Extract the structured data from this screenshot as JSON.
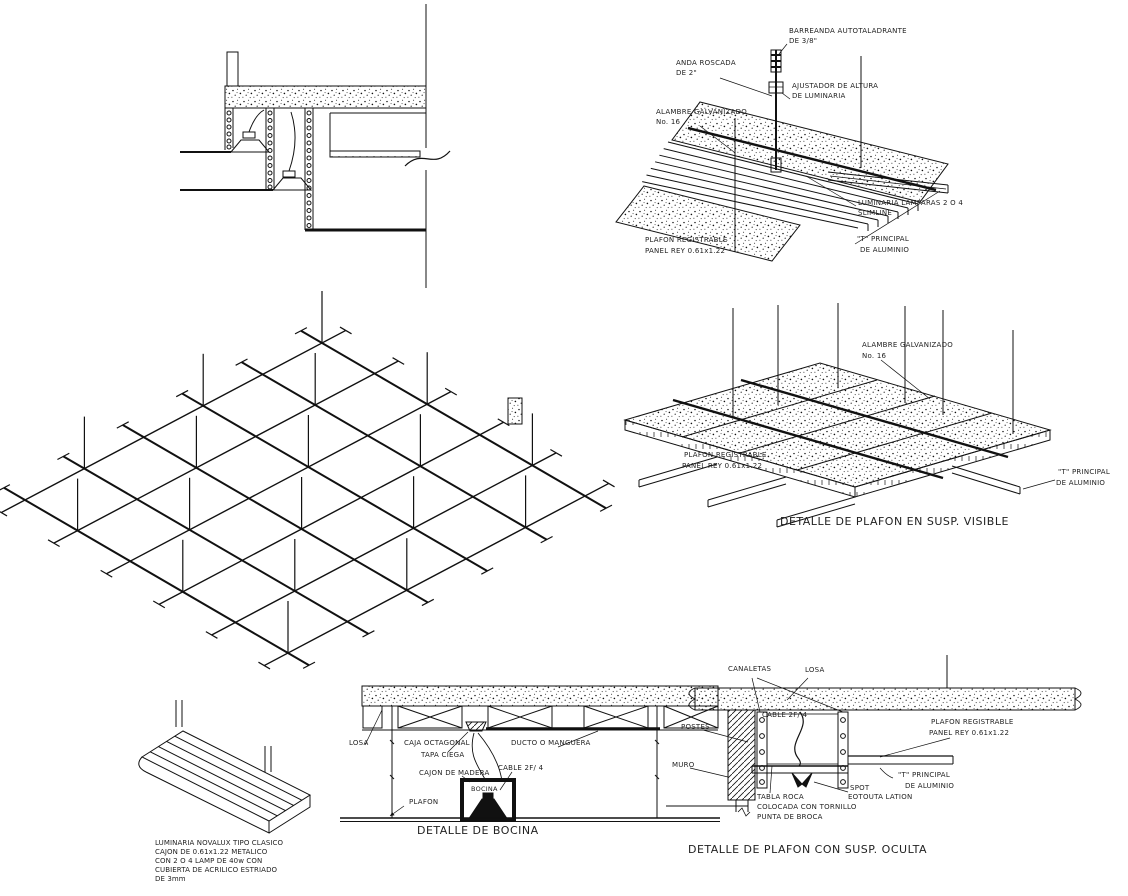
{
  "meta": {
    "background": "#ffffff",
    "ink": "#111111"
  },
  "top_right": {
    "barreanda_1": "BARREANDA AUTOTALADRANTE",
    "barreanda_2": "DE 3/8\"",
    "anda_1": "ANDA ROSCADA",
    "anda_2": "DE 2\"",
    "ajustador_1": "AJUSTADOR DE ALTURA",
    "ajustador_2": "DE LUMINARIA",
    "alambre_1": "ALAMBRE GALVANIZADO",
    "alambre_2": "No. 16",
    "luminaria_1": "LUMINARIA LAMPARAS 2 O 4",
    "luminaria_2": "SLIMLINE",
    "plafon_1": "PLAFON REGISTRABLE",
    "plafon_2": "PANEL REY 0.61x1.22",
    "t_principal_1": "\"T\" PRINCIPAL",
    "t_principal_2": "DE ALUMINIO"
  },
  "mid_right": {
    "alambre_1": "ALAMBRE GALVANIZADO",
    "alambre_2": "No. 16",
    "plafon_1": "PLAFON REGISTRABLE",
    "plafon_2": "PANEL REY 0.61x1.22",
    "t_principal_1": "\"T\" PRINCIPAL",
    "t_principal_2": "DE ALUMINIO",
    "title": "DETALLE DE PLAFON EN SUSP. VISIBLE"
  },
  "luminaire": {
    "note_1": "LUMINARIA NOVALUX TIPO CLASICO",
    "note_2": "CAJON DE 0.61x1.22 METALICO",
    "note_3": "CON 2 O 4 LAMP DE 40w CON",
    "note_4": "CUBIERTA DE ACRILICO ESTRIADO",
    "note_5": "DE 3mm"
  },
  "bocina": {
    "losa": "LOSA",
    "caja_1": "CAJA OCTAGONAL",
    "caja_2": "TAPA CIEGA",
    "cajon": "CAJON DE MADERA",
    "ducto": "DUCTO O MANGUERA",
    "cable": "CABLE 2F/ 4",
    "bocina": "BOCINA",
    "plafon": "PLAFON",
    "title": "DETALLE DE BOCINA"
  },
  "oculta": {
    "canaletas": "CANALETAS",
    "losa": "LOSA",
    "cable": "CABLE 2F/ 4",
    "postes": "POSTES",
    "muro": "MURO",
    "plafon_1": "PLAFON REGISTRABLE",
    "plafon_2": "PANEL REY 0.61x1.22",
    "t_principal_1": "\"T\" PRINCIPAL",
    "t_principal_2": "DE ALUMINIO",
    "spot_1": "SPOT",
    "spot_2": "EOTOUTA LATION",
    "tabla_1": "TABLA ROCA",
    "tabla_2": "COLOCADA CON TORNILLO",
    "tabla_3": "PUNTA DE BROCA",
    "title": "DETALLE DE PLAFON CON SUSP. OCULTA"
  }
}
